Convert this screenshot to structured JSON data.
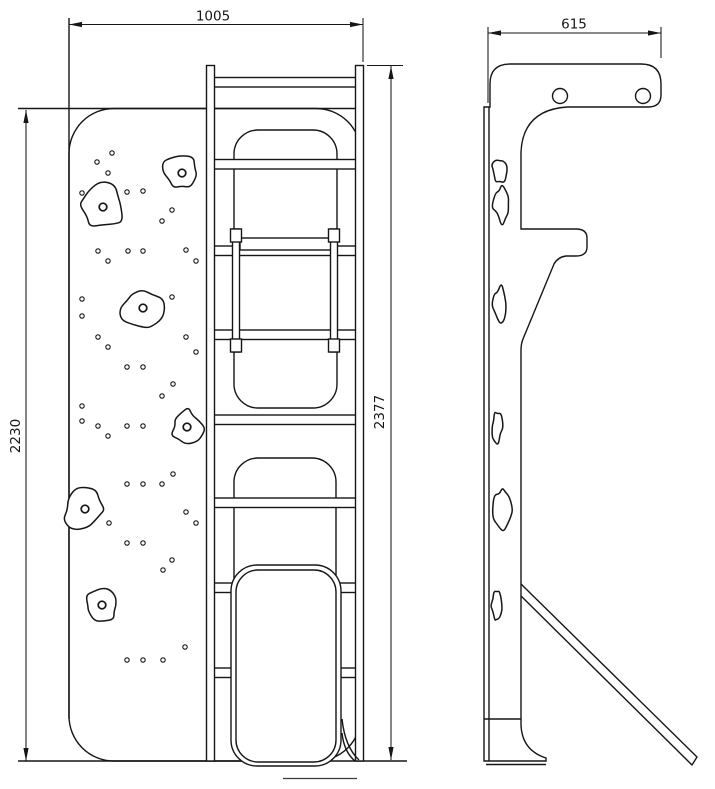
{
  "drawing": {
    "type": "technical-orthographic-drawing",
    "subject": "climbing-wall-ladder-frame-with-slide",
    "colors": {
      "background": "#ffffff",
      "line": "#161616"
    },
    "dimensions": {
      "front_width": "1005",
      "wall_height": "2230",
      "overall_height": "2377",
      "side_depth": "615"
    },
    "front_view": {
      "hole_radius": 2.2,
      "bolt_radius": 3.8,
      "climb_holds": [
        {
          "cx": 182,
          "cy": 173,
          "rx": 21,
          "ry": 17,
          "seed": 3,
          "bolt": true
        },
        {
          "cx": 103,
          "cy": 207,
          "rx": 25,
          "ry": 22,
          "seed": 7,
          "bolt": true
        },
        {
          "cx": 143,
          "cy": 308,
          "rx": 23,
          "ry": 21,
          "seed": 11,
          "bolt": true
        },
        {
          "cx": 187,
          "cy": 427,
          "rx": 17,
          "ry": 19,
          "seed": 5,
          "bolt": true
        },
        {
          "cx": 85,
          "cy": 509,
          "rx": 23,
          "ry": 22,
          "seed": 13,
          "bolt": true
        },
        {
          "cx": 102,
          "cy": 605,
          "rx": 18,
          "ry": 17,
          "seed": 17,
          "bolt": true
        }
      ],
      "panel_holes": [
        [
          97,
          162
        ],
        [
          112,
          153
        ],
        [
          108,
          173
        ],
        [
          82,
          193
        ],
        [
          127,
          192
        ],
        [
          143,
          191
        ],
        [
          172,
          210
        ],
        [
          162,
          221
        ],
        [
          98,
          251
        ],
        [
          128,
          251
        ],
        [
          143,
          251
        ],
        [
          108,
          261
        ],
        [
          186,
          250
        ],
        [
          196,
          261
        ],
        [
          82,
          299
        ],
        [
          82,
          316
        ],
        [
          172,
          297
        ],
        [
          162,
          308
        ],
        [
          98,
          337
        ],
        [
          186,
          337
        ],
        [
          108,
          347
        ],
        [
          196,
          352
        ],
        [
          127,
          367
        ],
        [
          143,
          367
        ],
        [
          173,
          384
        ],
        [
          162,
          396
        ],
        [
          82,
          406
        ],
        [
          82,
          421
        ],
        [
          98,
          426
        ],
        [
          127,
          426
        ],
        [
          143,
          426
        ],
        [
          108,
          436
        ],
        [
          173,
          474
        ],
        [
          127,
          484
        ],
        [
          143,
          484
        ],
        [
          162,
          484
        ],
        [
          186,
          512
        ],
        [
          196,
          523
        ],
        [
          109,
          523
        ],
        [
          127,
          543
        ],
        [
          143,
          543
        ],
        [
          172,
          560
        ],
        [
          163,
          570
        ],
        [
          185,
          647
        ],
        [
          127,
          660
        ],
        [
          143,
          660
        ],
        [
          163,
          660
        ]
      ]
    },
    "side_view": {
      "top_beam_hole_radius": 7.5,
      "top_beam_holes": [
        [
          560,
          96
        ],
        [
          643,
          96
        ]
      ],
      "climb_holds": [
        {
          "cx": 500,
          "cy": 170,
          "rx": 8,
          "ry": 13,
          "seed": 21,
          "bolt": false
        },
        {
          "cx": 502,
          "cy": 204,
          "rx": 9,
          "ry": 20,
          "seed": 23,
          "bolt": false
        },
        {
          "cx": 500,
          "cy": 306,
          "rx": 8,
          "ry": 21,
          "seed": 29,
          "bolt": false
        },
        {
          "cx": 497,
          "cy": 427,
          "rx": 5.5,
          "ry": 16,
          "seed": 31,
          "bolt": false
        },
        {
          "cx": 502,
          "cy": 509,
          "rx": 9,
          "ry": 20,
          "seed": 37,
          "bolt": false
        },
        {
          "cx": 497,
          "cy": 605,
          "rx": 5.5,
          "ry": 16,
          "seed": 41,
          "bolt": false
        }
      ]
    }
  }
}
